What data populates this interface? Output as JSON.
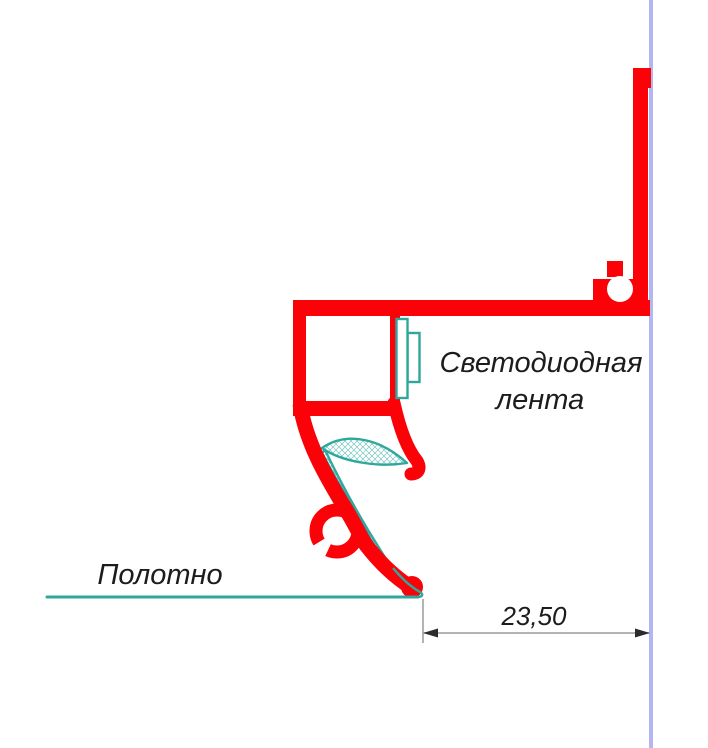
{
  "diagram": {
    "type": "technical-profile-cross-section",
    "labels": {
      "led_strip_line1": "Светодиодная",
      "led_strip_line2": "лента",
      "canvas": "Полотно",
      "dimension_value": "23,50"
    },
    "colors": {
      "profile_red": "#fa0208",
      "seal_teal": "#2ea79d",
      "wall_blue": "#b4b6f2",
      "dimension_gray": "#9a9a9a",
      "arrow_black": "#2b2b2b",
      "text_black": "#1c1c1c"
    }
  }
}
